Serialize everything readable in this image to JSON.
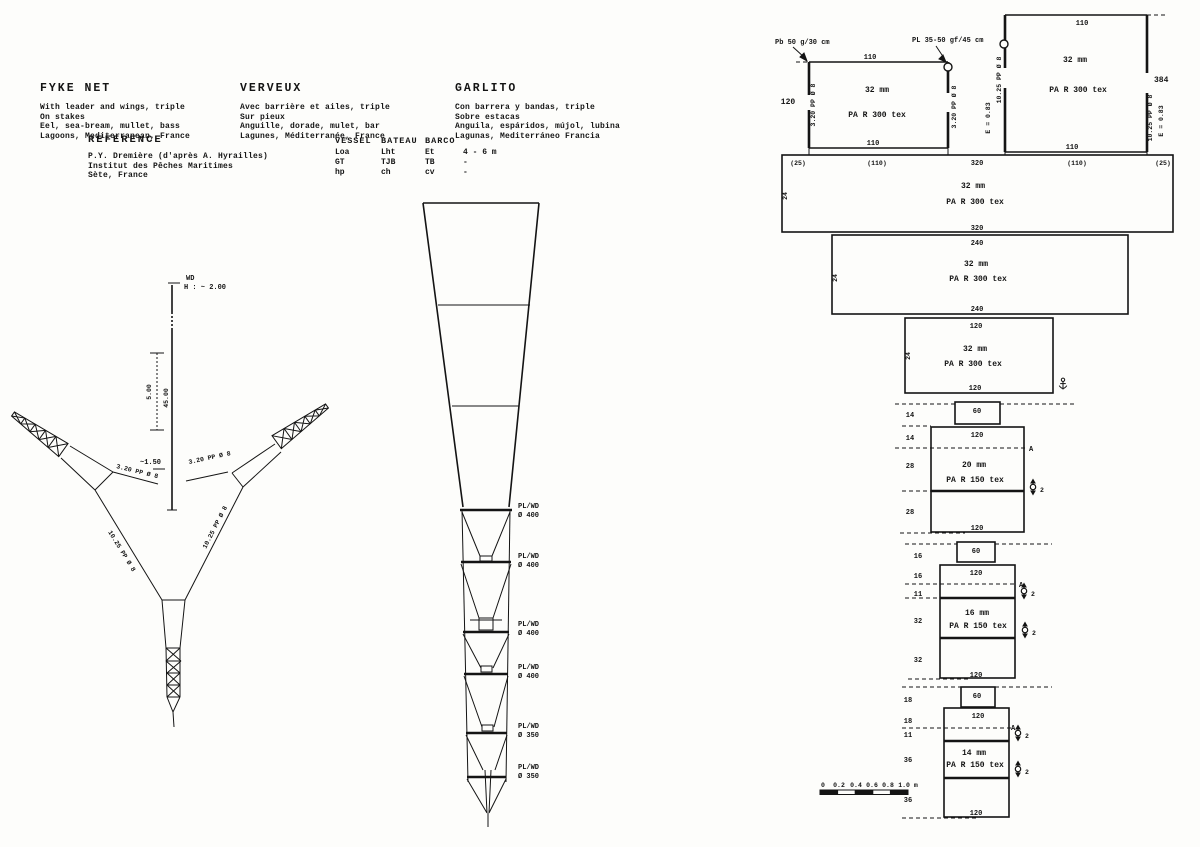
{
  "doc": {
    "lang_blocks": [
      {
        "title": "FYKE NET",
        "lines": [
          "With leader and wings, triple",
          "On stakes",
          "Eel, sea-bream, mullet, bass",
          "Lagoons, Mediterranean, France"
        ]
      },
      {
        "title": "VERVEUX",
        "lines": [
          "Avec barrière et ailes, triple",
          "Sur pieux",
          "Anguille, dorade, mulet, bar",
          "Lagunes, Méditerranée, France"
        ]
      },
      {
        "title": "GARLITO",
        "lines": [
          "Con barrera y bandas, triple",
          "Sobre estacas",
          "Anguila, espáridos, mújol, lubina",
          "Lagunas, Mediterráneo Francia"
        ]
      }
    ],
    "reference": {
      "title": "REFERENCE",
      "lines": [
        "P.Y. Dremière (d'après A. Hyrailles)",
        "Institut des Pêches Maritimes",
        "Sète, France"
      ]
    },
    "vessel": {
      "headers": [
        "VESSEL",
        "BATEAU",
        "BARCO"
      ],
      "rows": [
        [
          "Loa",
          "Lht",
          "Et",
          "4 - 6 m"
        ],
        [
          "GT",
          "TJB",
          "TB",
          "-"
        ],
        [
          "hp",
          "ch",
          "cv",
          "-"
        ]
      ]
    }
  },
  "plan": {
    "stake": "WD",
    "height": "H : ~ 2.00",
    "dim5": "5.00",
    "leader_len": "45.00",
    "gap": "~1.50",
    "rope320_left": "3.20 PP Ø 8",
    "rope320_right": "3.20 PP Ø 8",
    "rope1025_left": "10.25 PP Ø 8",
    "rope1025_right": "10.25 PP Ø 8"
  },
  "side": {
    "hoops": [
      {
        "l1": "PL/WD",
        "l2": "Ø 400"
      },
      {
        "l1": "PL/WD",
        "l2": "Ø 400"
      },
      {
        "l1": "PL/WD",
        "l2": "Ø 400"
      },
      {
        "l1": "PL/WD",
        "l2": "Ø 400"
      },
      {
        "l1": "PL/WD",
        "l2": "Ø 350"
      },
      {
        "l1": "PL/WD",
        "l2": "Ø 350"
      }
    ]
  },
  "net": {
    "pb": "Pb 50 g/30 cm",
    "pl": "PL 35-50 gf/45 cm",
    "p1": {
      "top": "110",
      "mesh": "32 mm",
      "twine": "PA R 300 tex",
      "bottom": "110",
      "depth": "120",
      "rope_l": "3.20 PP Ø 8",
      "rope_r": "3.20 PP Ø 8"
    },
    "p2": {
      "top": "110",
      "mesh": "32 mm",
      "twine": "PA R 300 tex",
      "bottom": "110",
      "depth": "384",
      "rope_l": "10.25 PP Ø 8",
      "e_l": "E = 0.83",
      "rope_r": "10.25 PP Ø 8",
      "e_r": "E = 0.83"
    },
    "row": [
      "(25)",
      "(110)",
      "320",
      "(110)",
      "(25)"
    ],
    "w1": {
      "mesh": "32 mm",
      "twine": "PA R 300 tex",
      "side": "24",
      "bottom": "320"
    },
    "w2": {
      "top": "240",
      "mesh": "32 mm",
      "twine": "PA R 300 tex",
      "side": "24",
      "bottom": "240"
    },
    "w3": {
      "top": "120",
      "mesh": "32 mm",
      "twine": "PA R 300 tex",
      "side": "24",
      "bottom": "120"
    },
    "s1": {
      "box": "60",
      "counts": [
        "14",
        "14",
        "28",
        "28"
      ],
      "top": "120",
      "mesh": "20 mm",
      "twine": "PA R 150 tex",
      "bottom": "120",
      "a": "A",
      "r1": "2"
    },
    "s2": {
      "box": "60",
      "counts": [
        "16",
        "16",
        "11",
        "32",
        "32"
      ],
      "top": "120",
      "mesh": "16 mm",
      "twine": "PA R 150 tex",
      "bottom": "120",
      "a": "A",
      "r1": "2",
      "r2": "2"
    },
    "s3": {
      "box": "60",
      "counts": [
        "18",
        "18",
        "11",
        "36",
        "36"
      ],
      "top": "120",
      "mesh": "14 mm",
      "twine": "PA R 150 tex",
      "bottom": "120",
      "a": "A",
      "r1": "2",
      "r2": "2"
    },
    "scale": [
      "0",
      "0.2",
      "0.4",
      "0.6",
      "0.8",
      "1.0 m"
    ]
  }
}
